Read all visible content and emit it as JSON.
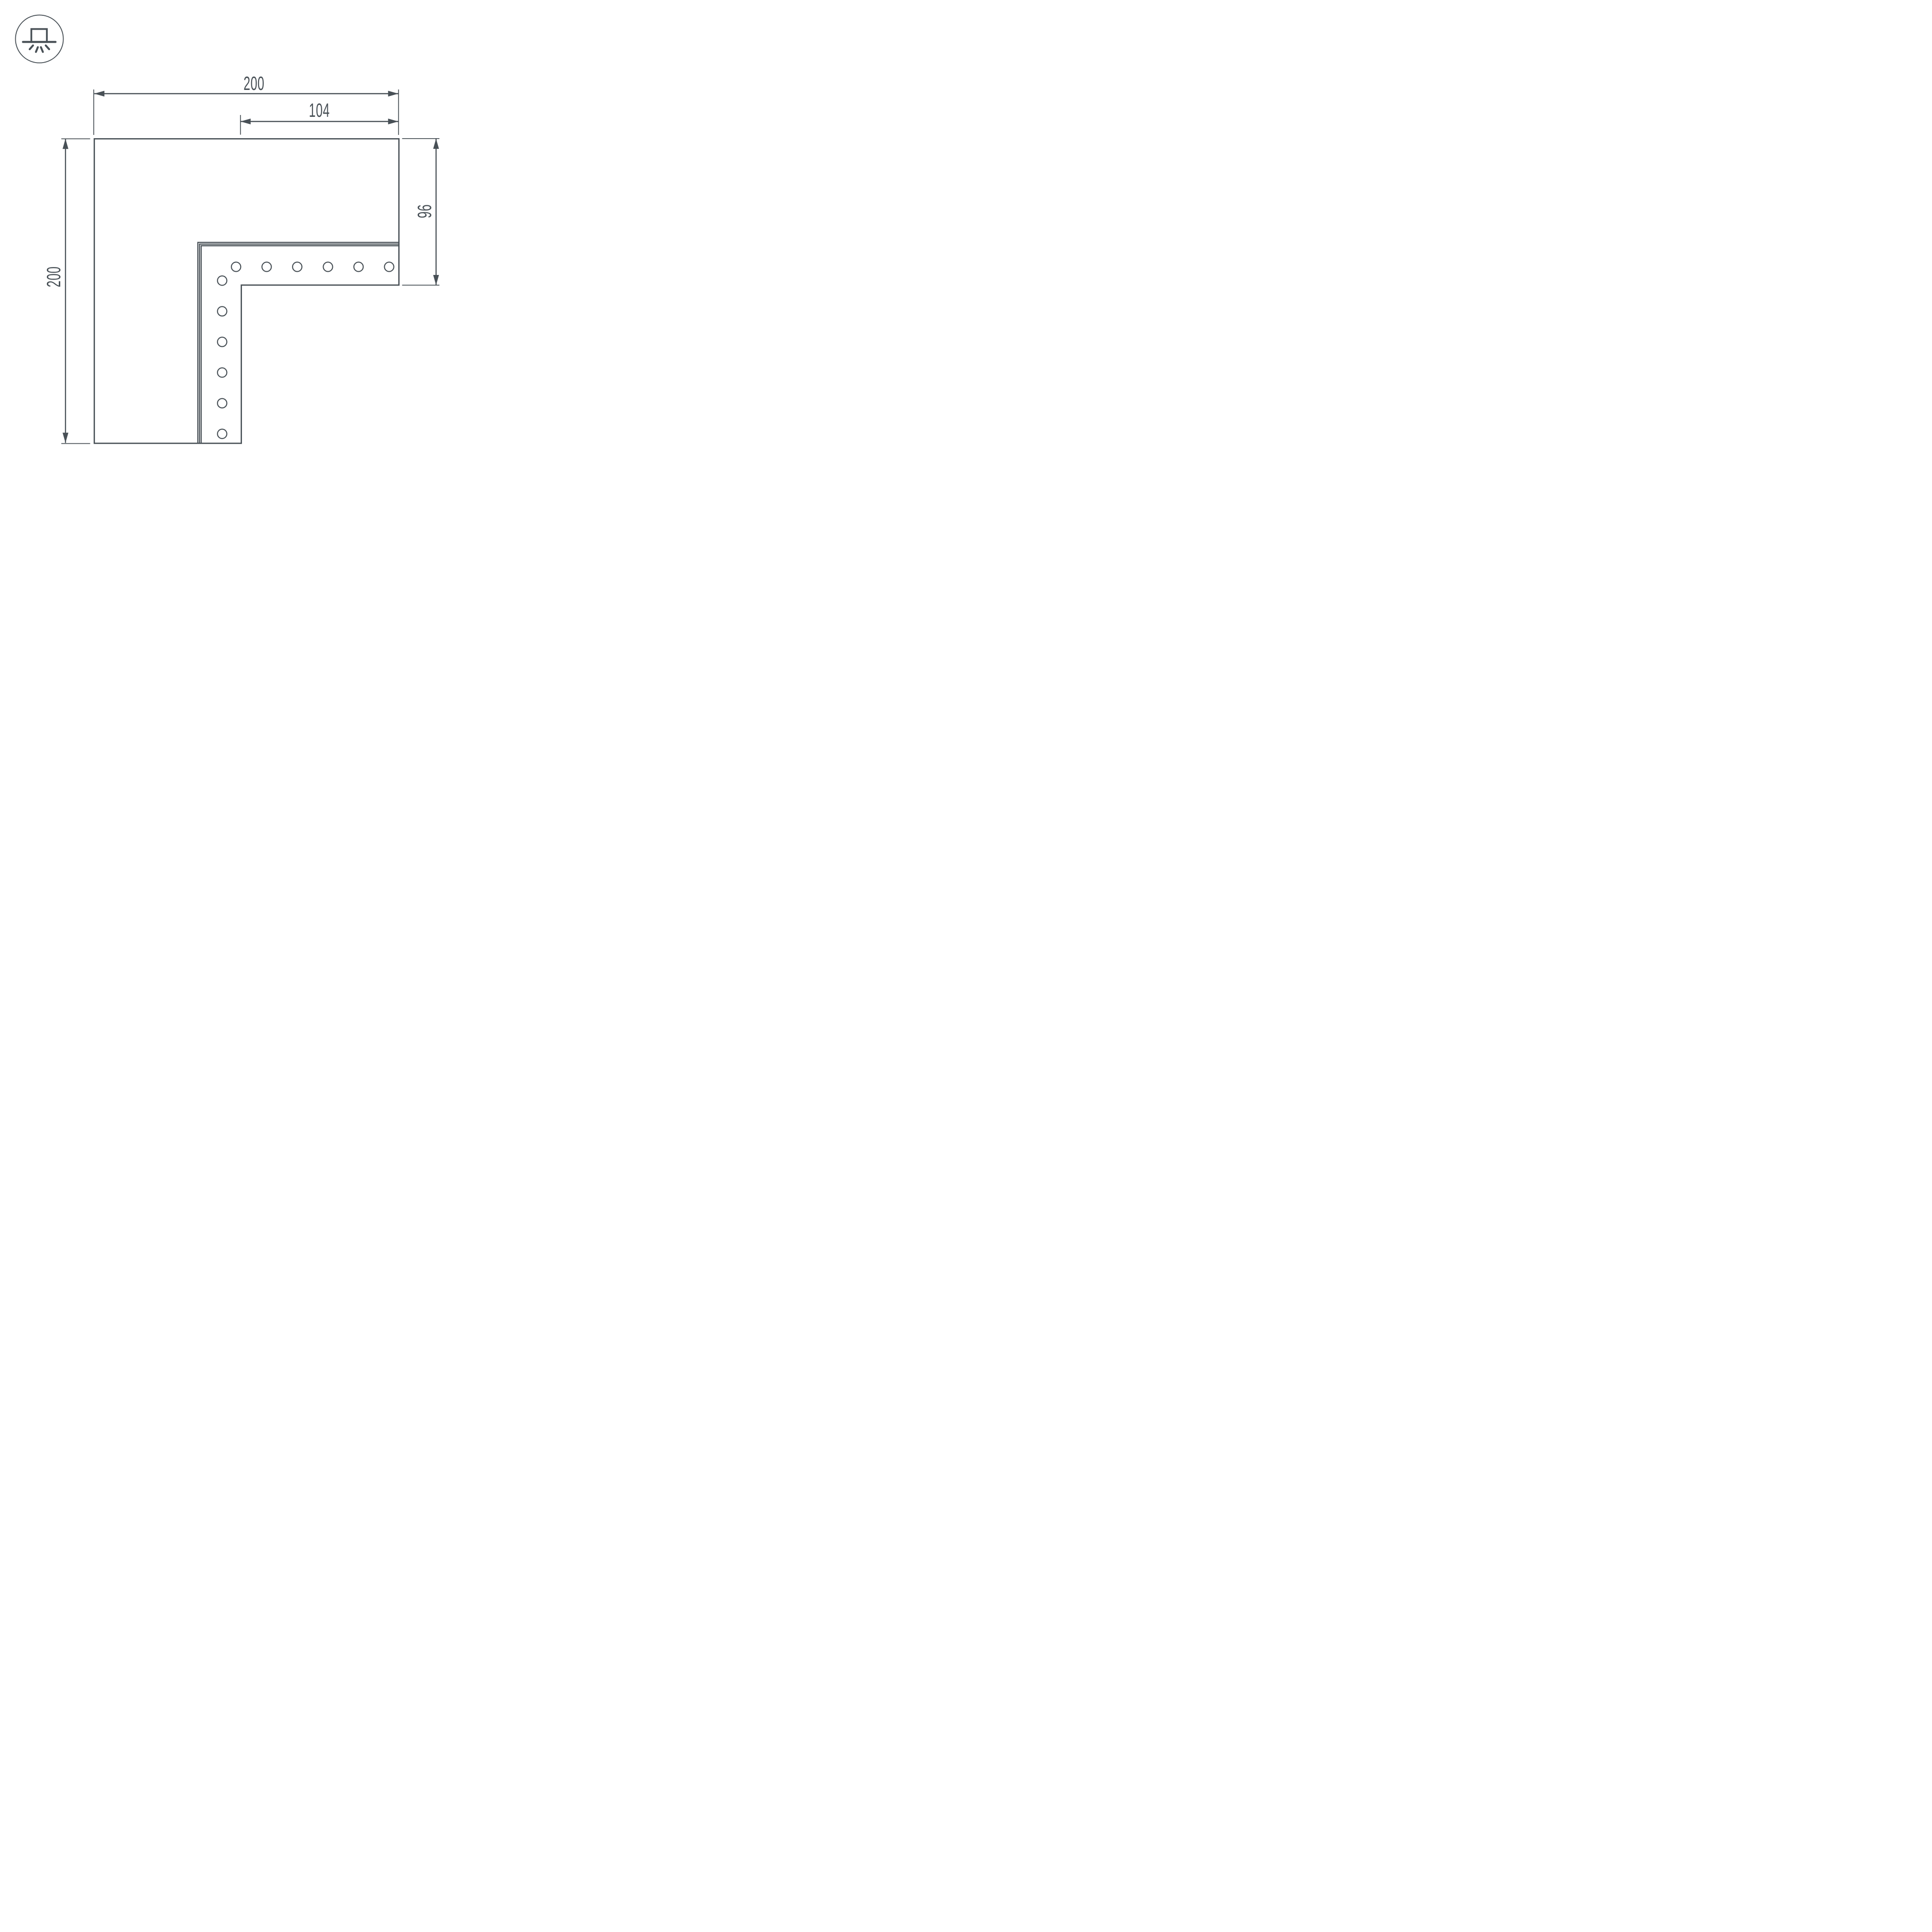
{
  "page": {
    "background": "#ffffff",
    "line_color": "#485056"
  },
  "icon": {
    "name": "surface-mount-light-icon"
  },
  "dimensions": {
    "top_width": {
      "value": "200"
    },
    "inner_width": {
      "value": "104"
    },
    "left_height": {
      "value": "200"
    },
    "right_height": {
      "value": "96"
    }
  },
  "holes": {
    "horizontal_row_count": 6,
    "vertical_column_count": 6
  }
}
